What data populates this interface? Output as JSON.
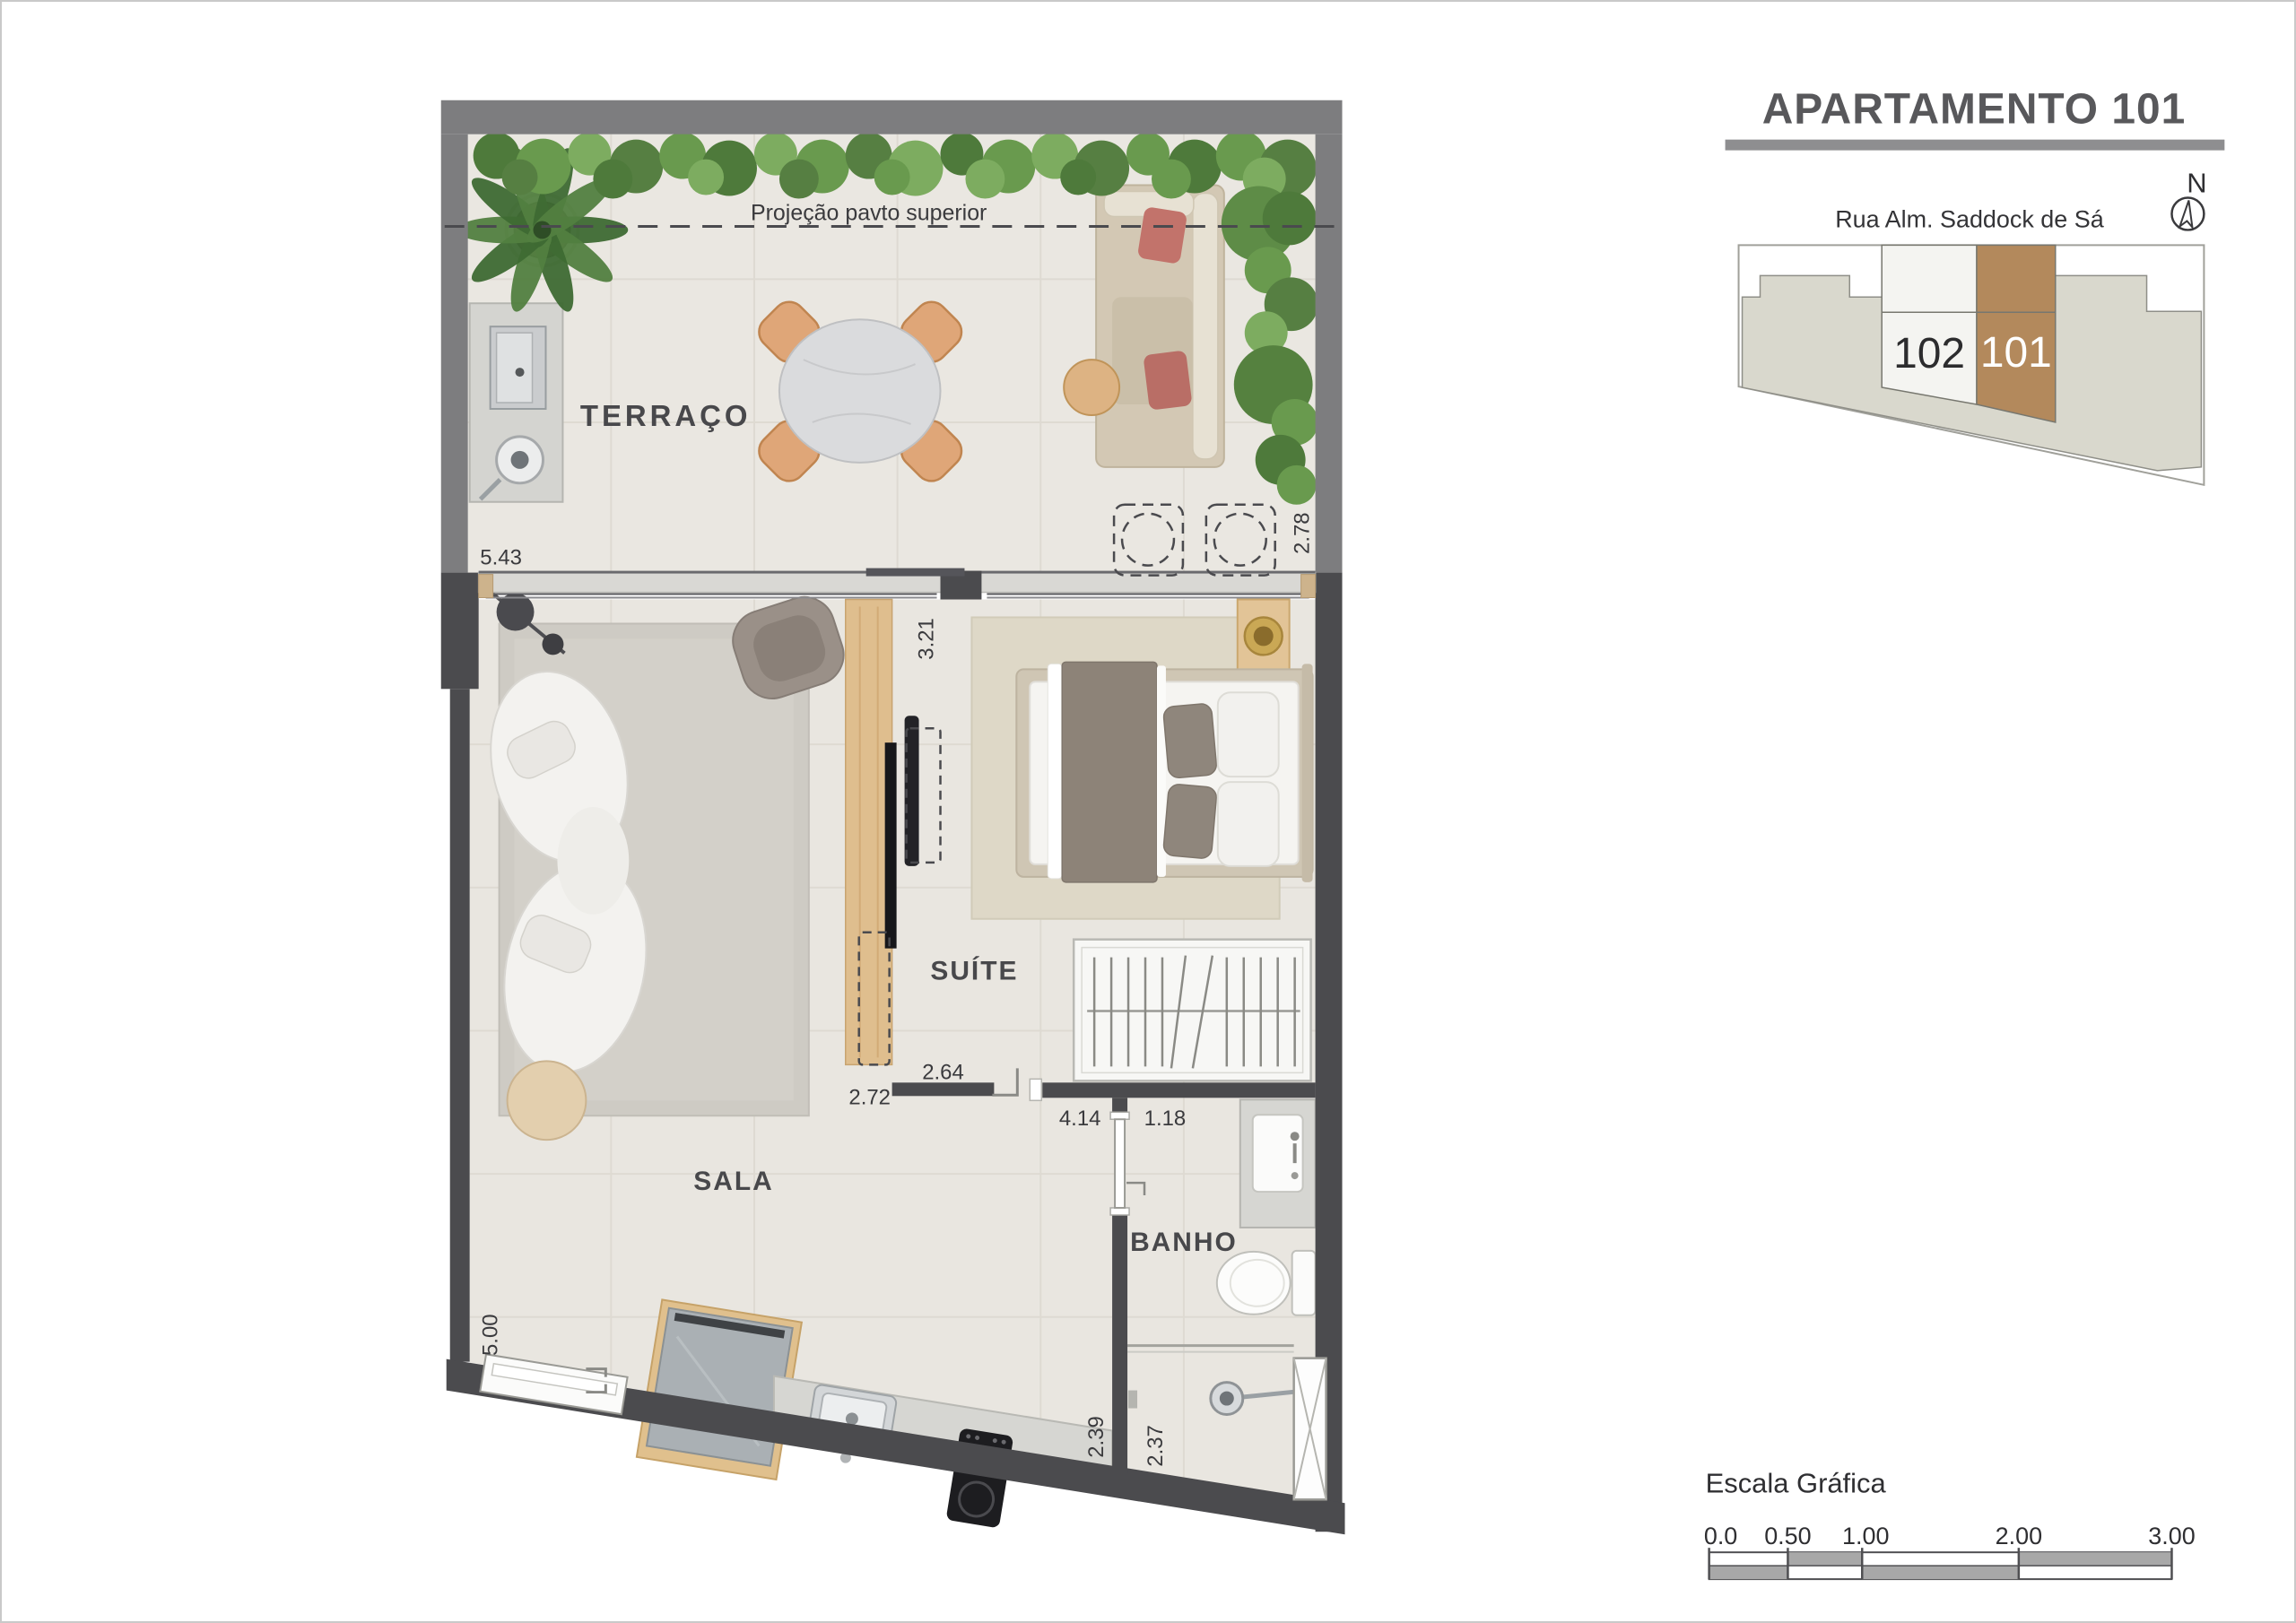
{
  "header": {
    "title": "APARTAMENTO 101"
  },
  "location": {
    "street": "Rua Alm. Saddock de Sá",
    "north": "N",
    "units": [
      {
        "id": "102"
      },
      {
        "id": "101"
      }
    ]
  },
  "plan": {
    "rooms": {
      "terrace": "TERRAÇO",
      "living": "SALA",
      "suite": "SUÍTE",
      "bath": "BANHO"
    },
    "annotation": {
      "projection": "Projeção pavto superior"
    },
    "dims": {
      "terrace_front": "5.43",
      "terrace_side": "2.78",
      "suite_side": "3.21",
      "tv_wall": "2.72",
      "suite_front": "2.64",
      "living_length": "4.14",
      "bath_front": "1.18",
      "living_side": "5.00",
      "kitchen_side": "2.39",
      "shower_side": "2.37"
    }
  },
  "scale": {
    "title": "Escala Gráfica",
    "ticks": [
      "0.0",
      "0.50",
      "1.00",
      "2.00",
      "3.00"
    ]
  },
  "palette": {
    "unit_highlight": "#b3895c",
    "wall_dark": "#4b4b4e",
    "wall_terrace": "#7d7d7f",
    "hedge_green": "#5e8c47"
  }
}
